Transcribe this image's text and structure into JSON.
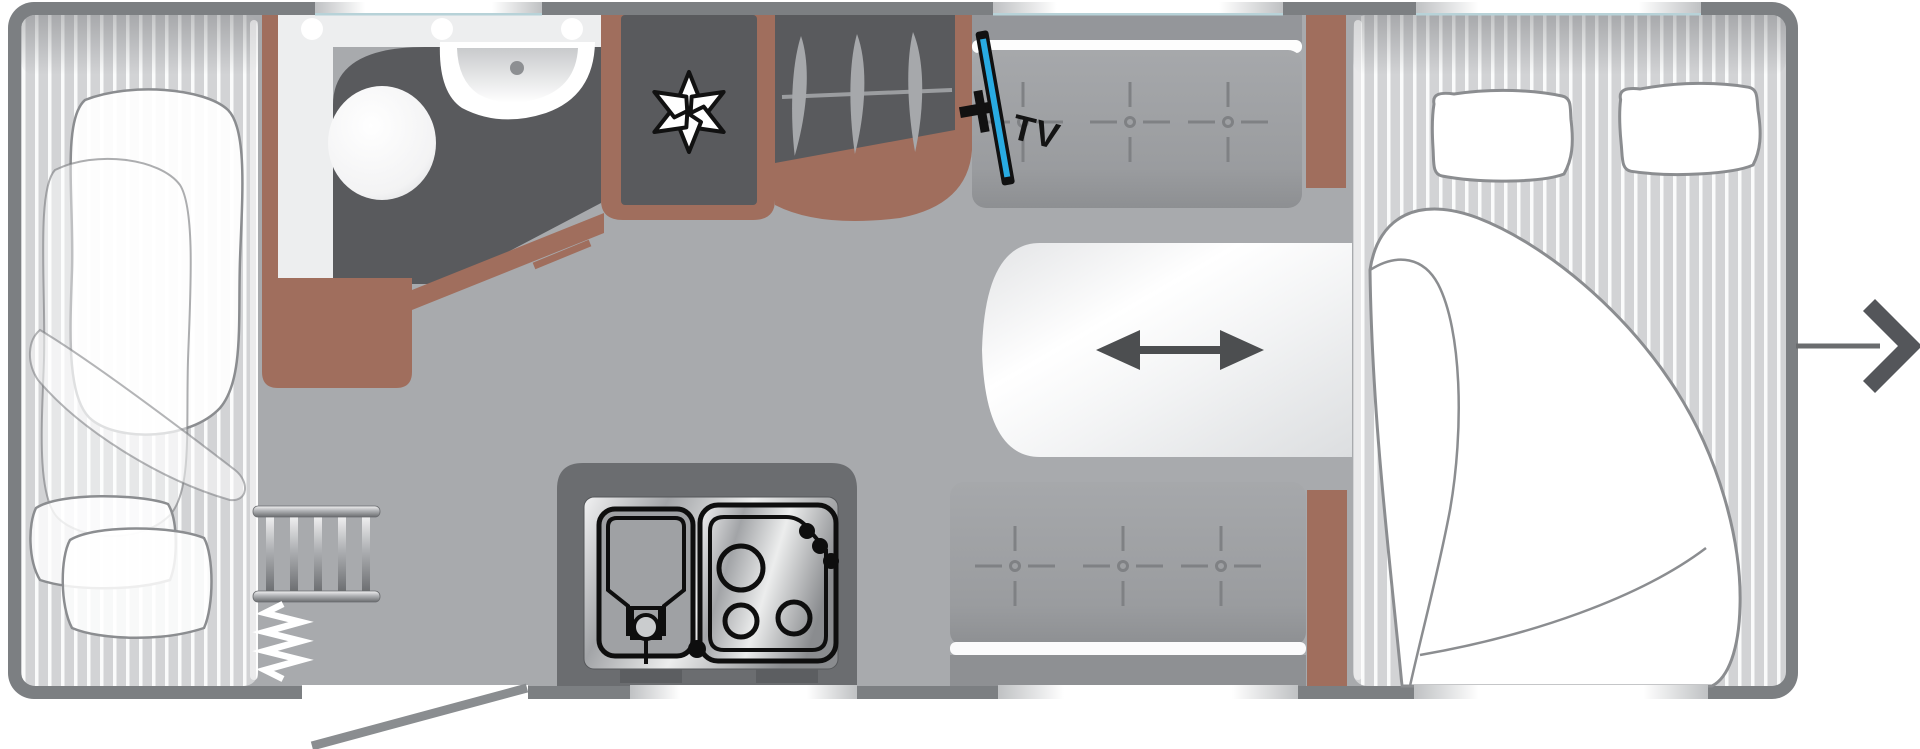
{
  "diagram": {
    "type": "caravan-floor-plan-top-view",
    "labels": {
      "tv": "TV"
    },
    "icons": {
      "fan_asterisk": "fan-asterisk-icon",
      "clothes_hangers": "clothes-hangers-icon",
      "tv_screen": "tv-icon",
      "table_slide_arrow": "double-arrow-icon",
      "travel_direction_arrow": "right-arrow-icon",
      "seat_stitch_marks": "stitch-cross-icon",
      "bunk_ladder": "ladder-icon",
      "curtain_divider": "zigzag-icon"
    },
    "colors": {
      "wall_gray": "#7c7f82",
      "floor_gray": "#a8aaad",
      "furniture_dark_gray": "#58595c",
      "wood_brown": "#a06e5d",
      "bench_gray": "#9ea0a4",
      "mattress_gray": "#d2d3d5",
      "tv_screen_blue": "#29abe2",
      "window_white": "#ffffff",
      "arrow_dark": "#54565a"
    },
    "features": [
      "front-bed",
      "bathroom-with-toilet-and-sink",
      "refrigerator-with-fan-symbol",
      "wardrobe-with-hangers",
      "tv-mount",
      "front-bench-seat",
      "sliding-table",
      "rear-bench-seat",
      "kitchen-sink-and-stove",
      "bunk-ladder",
      "curtain-divider",
      "entry-door",
      "rear-double-bed-with-pillows",
      "travel-direction-arrow"
    ]
  }
}
